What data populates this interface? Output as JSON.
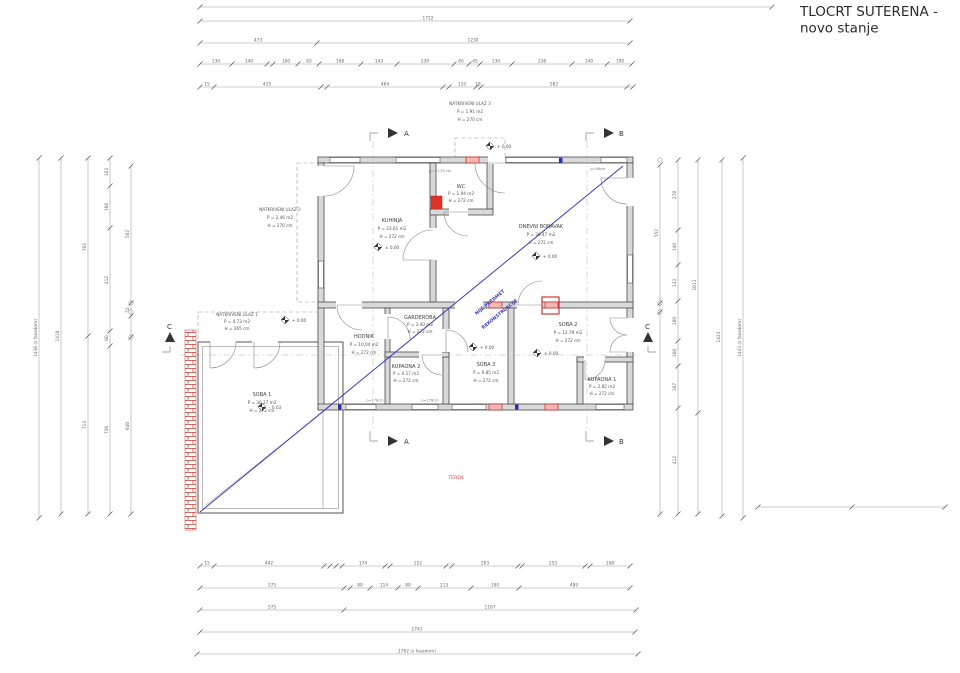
{
  "title": {
    "line1": "TLOCRT SUTERENA -",
    "line2": "novo stanje"
  },
  "rooms": {
    "kuhinja": {
      "name": "KUHINJA",
      "area": "P = 23.61 m2",
      "height": "H = 272 cm"
    },
    "wc": {
      "name": "WC",
      "area": "P = 1.94 m2",
      "height": "H = 272 cm"
    },
    "dnevni": {
      "name": "DNEVNI BORAVAK",
      "area": "P = 36.47 m2",
      "height": "H = 272 cm"
    },
    "hodnik": {
      "name": "HODNIK",
      "area": "P = 10.04 m2",
      "height": "H = 272 cm"
    },
    "garderoba": {
      "name": "GARDEROBA",
      "area": "P = 3.40 m2",
      "height": "H = 272 cm"
    },
    "kupaona2": {
      "name": "KUPAONA 2",
      "area": "P = 4.17 m2",
      "height": "H = 272 cm"
    },
    "soba3": {
      "name": "SOBA 3",
      "area": "P = 9.85 m2",
      "height": "H = 272 cm"
    },
    "soba2": {
      "name": "SOBA 2",
      "area": "P = 12.79 m2",
      "height": "H = 272 cm"
    },
    "kupaona1": {
      "name": "KUPAONA 1",
      "area": "P = 2.82 m2",
      "height": "H = 272 cm"
    },
    "soba1": {
      "name": "SOBA 1",
      "area": "P = 30.27 m2",
      "height": "H = 272 cm"
    },
    "ulaz1": {
      "name": "NATKRIVENI ULAZ 1",
      "area": "P = 4.73 m2",
      "height": "H = 265 cm"
    },
    "ulaz2": {
      "name": "NATKRIVENI ULAZ 2",
      "area": "P = 2.46 m2",
      "height": "H = 270 cm"
    },
    "ulaz3": {
      "name": "NATKRIVENI ULAZ 3",
      "area": "P = 1.91 m2",
      "height": "H = 270 cm"
    }
  },
  "annotations": {
    "reconstruction_note_line1": "NIJE PREDMET",
    "reconstruction_note_line2": "REKONSTRUKCIJE",
    "teren": "TEREN",
    "section_a": "A",
    "section_b": "B",
    "section_c": "C",
    "elev_kuhinja": "± 0.00",
    "elev_dnevni": "+ 0.00",
    "elev_soba3": "+ 0.00",
    "elev_soba2": "+ 0.00",
    "elev_soba1": "- 0.03",
    "elev_ulaz1": "+ 0.00",
    "elev_ulaz3": "+ 0.00",
    "wall_note_top": "p=+1.30 cm",
    "wall_note_bottom1": "p=178cm",
    "wall_note_bottom2": "p=178cm",
    "wall_note_right": "p=98cm"
  },
  "colors": {
    "new_wall_stroke": "#cc2222",
    "new_wall_fill": "#f3b7b2",
    "reconstruction_line": "#3a3ac0",
    "wall_fill": "#d9d9d9",
    "wall_stroke": "#4a4a4a",
    "hatch_red": "#c0392b",
    "teren_red": "#cc4444"
  },
  "dimensions": {
    "horizontal": [
      {
        "y": 7,
        "ticks": [
          200,
          772
        ],
        "labels": []
      },
      {
        "y": 21,
        "ticks": [
          200,
          630
        ],
        "labels": [
          {
            "x": 428,
            "t": "1722"
          }
        ]
      },
      {
        "y": 43,
        "ticks": [
          200,
          317,
          630
        ],
        "labels": [
          {
            "x": 258,
            "t": "473"
          },
          {
            "x": 473,
            "t": "1230"
          }
        ]
      },
      {
        "y": 64,
        "ticks": [
          200,
          232,
          267,
          273,
          298,
          319,
          361,
          397,
          454,
          469,
          480,
          512,
          572,
          607,
          632
        ],
        "labels": [
          {
            "x": 216,
            "t": "130"
          },
          {
            "x": 249,
            "t": "140"
          },
          {
            "x": 286,
            "t": "100"
          },
          {
            "x": 309,
            "t": "83"
          },
          {
            "x": 340,
            "t": "168"
          },
          {
            "x": 379,
            "t": "143"
          },
          {
            "x": 425,
            "t": "230"
          },
          {
            "x": 461,
            "t": "60"
          },
          {
            "x": 475,
            "t": "45"
          },
          {
            "x": 496,
            "t": "130"
          },
          {
            "x": 542,
            "t": "238"
          },
          {
            "x": 589,
            "t": "140"
          },
          {
            "x": 620,
            "t": "100"
          }
        ]
      },
      {
        "y": 87,
        "ticks": [
          200,
          214,
          321,
          327,
          443,
          449,
          476,
          481,
          627,
          633
        ],
        "labels": [
          {
            "x": 207,
            "t": "15"
          },
          {
            "x": 267,
            "t": "425"
          },
          {
            "x": 385,
            "t": "464"
          },
          {
            "x": 462,
            "t": "110"
          },
          {
            "x": 478,
            "t": "18"
          },
          {
            "x": 554,
            "t": "582"
          }
        ]
      },
      {
        "y": 566,
        "ticks": [
          200,
          214,
          324,
          330,
          336,
          342,
          385,
          390,
          446,
          452,
          518,
          522,
          585,
          590,
          630
        ],
        "labels": [
          {
            "x": 207,
            "t": "15"
          },
          {
            "x": 269,
            "t": "442"
          },
          {
            "x": 363,
            "t": "174"
          },
          {
            "x": 418,
            "t": "222"
          },
          {
            "x": 485,
            "t": "263"
          },
          {
            "x": 553,
            "t": "253"
          },
          {
            "x": 610,
            "t": "198"
          }
        ]
      },
      {
        "y": 588,
        "ticks": [
          200,
          344,
          350,
          370,
          398,
          418,
          471,
          519,
          630
        ],
        "labels": [
          {
            "x": 272,
            "t": "575"
          },
          {
            "x": 360,
            "t": "80"
          },
          {
            "x": 384,
            "t": "114"
          },
          {
            "x": 408,
            "t": "80"
          },
          {
            "x": 444,
            "t": "213"
          },
          {
            "x": 495,
            "t": "190"
          },
          {
            "x": 574,
            "t": "489"
          }
        ]
      },
      {
        "y": 610,
        "ticks": [
          200,
          344,
          636
        ],
        "labels": [
          {
            "x": 272,
            "t": "575"
          },
          {
            "x": 490,
            "t": "1167"
          }
        ]
      },
      {
        "y": 632,
        "ticks": [
          200,
          635
        ],
        "labels": [
          {
            "x": 417,
            "t": "1741"
          }
        ]
      },
      {
        "y": 654,
        "ticks": [
          197,
          638
        ],
        "labels": [
          {
            "x": 417,
            "t": "1762 (s fasadom)"
          }
        ]
      },
      {
        "y": 507,
        "ticks": [
          758,
          852,
          945
        ],
        "labels": []
      }
    ],
    "vertical": [
      {
        "x": 39,
        "ticks": [
          158,
          518
        ],
        "labels": [
          {
            "y": 338,
            "t": "1438 (s fasadom)"
          }
        ]
      },
      {
        "x": 61,
        "ticks": [
          158,
          514
        ],
        "labels": [
          {
            "y": 336,
            "t": "1418"
          }
        ]
      },
      {
        "x": 88,
        "ticks": [
          158,
          336,
          514
        ],
        "labels": [
          {
            "y": 247,
            "t": "702"
          },
          {
            "y": 425,
            "t": "714"
          }
        ]
      },
      {
        "x": 110,
        "ticks": [
          158,
          186,
          228,
          331,
          346,
          514
        ],
        "labels": [
          {
            "y": 172,
            "t": "103"
          },
          {
            "y": 207,
            "t": "168"
          },
          {
            "y": 280,
            "t": "412"
          },
          {
            "y": 338,
            "t": "60"
          },
          {
            "y": 430,
            "t": "736"
          }
        ]
      },
      {
        "x": 131,
        "ticks": [
          166,
          303,
          316,
          337,
          514
        ],
        "labels": [
          {
            "y": 234,
            "t": "502"
          },
          {
            "y": 310,
            "t": "52"
          },
          {
            "y": 426,
            "t": "640"
          }
        ]
      },
      {
        "x": 660,
        "ticks": [
          165,
          303,
          312,
          514
        ],
        "labels": [
          {
            "y": 233,
            "t": "552"
          }
        ]
      },
      {
        "x": 678,
        "ticks": [
          160,
          230,
          265,
          301,
          341,
          366,
          408,
          514
        ],
        "labels": [
          {
            "y": 195,
            "t": "278"
          },
          {
            "y": 247,
            "t": "140"
          },
          {
            "y": 283,
            "t": "143"
          },
          {
            "y": 321,
            "t": "180"
          },
          {
            "y": 353,
            "t": "100"
          },
          {
            "y": 387,
            "t": "167"
          },
          {
            "y": 460,
            "t": "412"
          }
        ]
      },
      {
        "x": 698,
        "ticks": [
          160,
          413,
          514
        ],
        "labels": [
          {
            "y": 285,
            "t": "1011"
          }
        ]
      },
      {
        "x": 722,
        "ticks": [
          160,
          516
        ],
        "labels": [
          {
            "y": 337,
            "t": "1423"
          }
        ]
      },
      {
        "x": 743,
        "ticks": [
          158,
          518
        ],
        "labels": [
          {
            "y": 338,
            "t": "1443 (s fasadom)"
          }
        ]
      }
    ]
  }
}
